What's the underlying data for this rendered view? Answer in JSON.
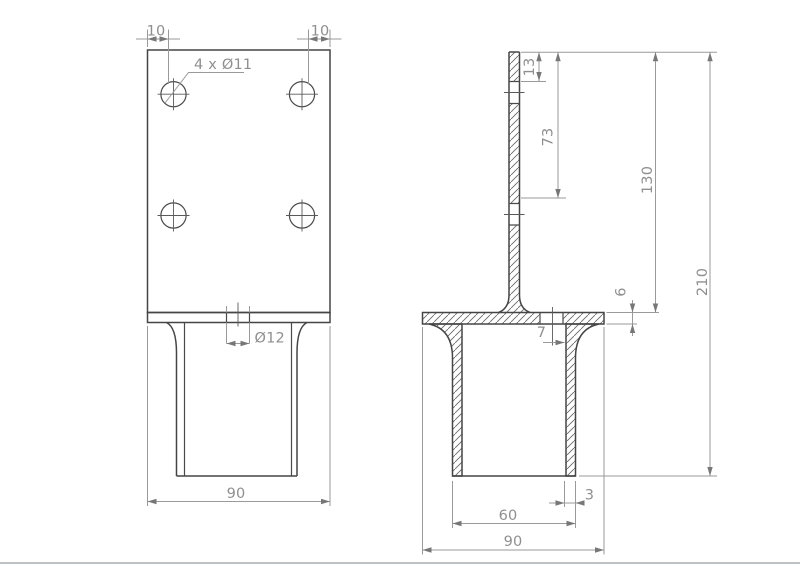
{
  "front": {
    "edge_offset_left": "10",
    "edge_offset_right": "10",
    "holes_note": "4 x Ø11",
    "base_hole": "Ø12",
    "plate_width": "90"
  },
  "section": {
    "top_to_hole1": "13",
    "top_to_hole2": "73",
    "plate_height": "130",
    "overall_height": "210",
    "base_thickness": "6",
    "hole_to_wall": "7",
    "wall_thickness": "3",
    "tube_width": "60",
    "base_width": "90"
  },
  "colors": {
    "background": "#ffffff",
    "outline": "#454545",
    "dimension_line": "#9a9a9a",
    "dimension_text": "#8f8f8f",
    "hatch": "#666666",
    "footer_rule": "#a9adb1"
  }
}
